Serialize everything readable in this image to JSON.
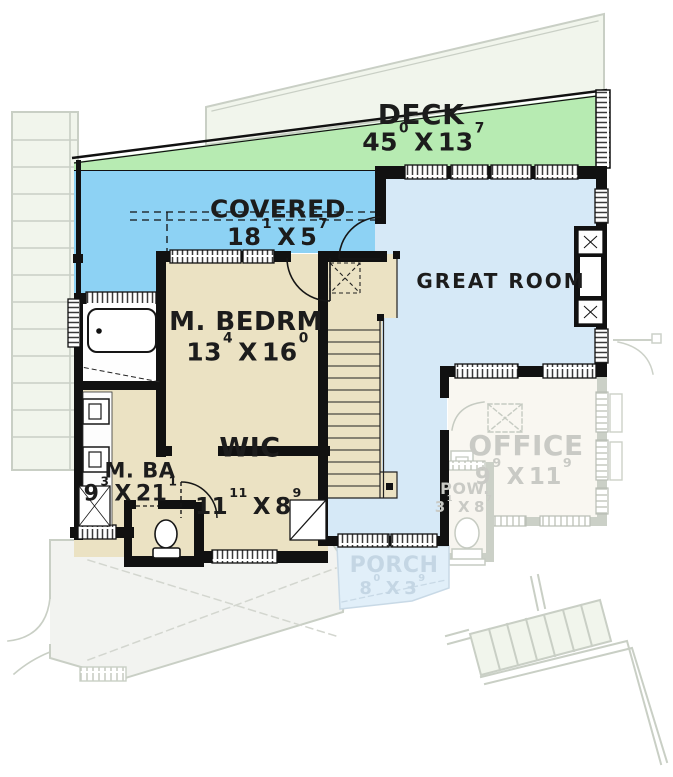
{
  "separator": "X",
  "rooms": {
    "deck": {
      "name": "DECK",
      "w": "45",
      "w_sup": "0",
      "l": "13",
      "l_sup": "7"
    },
    "covered": {
      "name": "COVERED",
      "w": "18",
      "w_sup": "1",
      "l": "5",
      "l_sup": "7"
    },
    "great_room": {
      "name": "GREAT ROOM"
    },
    "m_bedrm": {
      "name": "M. BEDRM",
      "w": "13",
      "w_sup": "4",
      "l": "16",
      "l_sup": "0"
    },
    "m_ba": {
      "name": "M. BA",
      "w": "9",
      "w_sup": "3",
      "l": "21",
      "l_sup": "1"
    },
    "wic": {
      "name": "WIC",
      "w": "11",
      "w_sup": "11",
      "l": "8",
      "l_sup": "9"
    },
    "office": {
      "name": "OFFICE",
      "w": "9",
      "w_sup": "9",
      "l": "11",
      "l_sup": "9"
    },
    "pow": {
      "name": "POW.",
      "w": "3",
      "w_sup": "1",
      "l": "8",
      "l_sup": "7"
    },
    "porch": {
      "name": "PORCH",
      "w": "8",
      "w_sup": "0",
      "l": "3",
      "l_sup": "9"
    }
  },
  "colors": {
    "deck_green": "#b7ebb2",
    "covered_blue": "#8dd2f4",
    "gr_blue": "#d6e9f7",
    "room_tan": "#ebe2c3",
    "wall": "#111111",
    "faded_outline": "#c9cfc5",
    "faded_fill": "#f1f5ec",
    "porch_fill": "#e1eff9",
    "faded_text": "#c9cac5",
    "porch_text": "#c4d6e4",
    "label_text": "#1c1c1c"
  }
}
